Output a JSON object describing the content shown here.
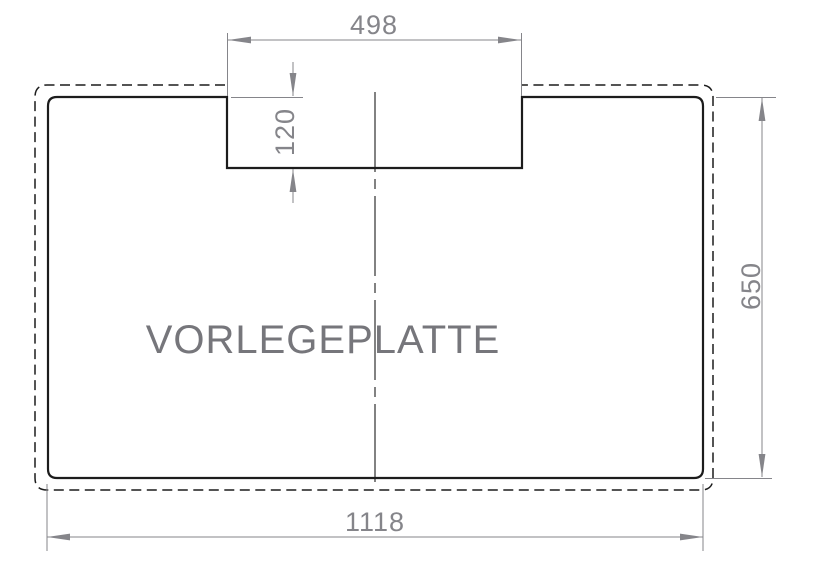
{
  "drawing": {
    "title": "VORLEGEPLATTE",
    "dimensions": {
      "notch_width": "498",
      "notch_depth": "120",
      "plate_height": "650",
      "plate_width": "1118"
    },
    "colors": {
      "line": "#1c1c1c",
      "dimension": "#85858a",
      "title": "#76767b",
      "background": "#ffffff"
    }
  }
}
